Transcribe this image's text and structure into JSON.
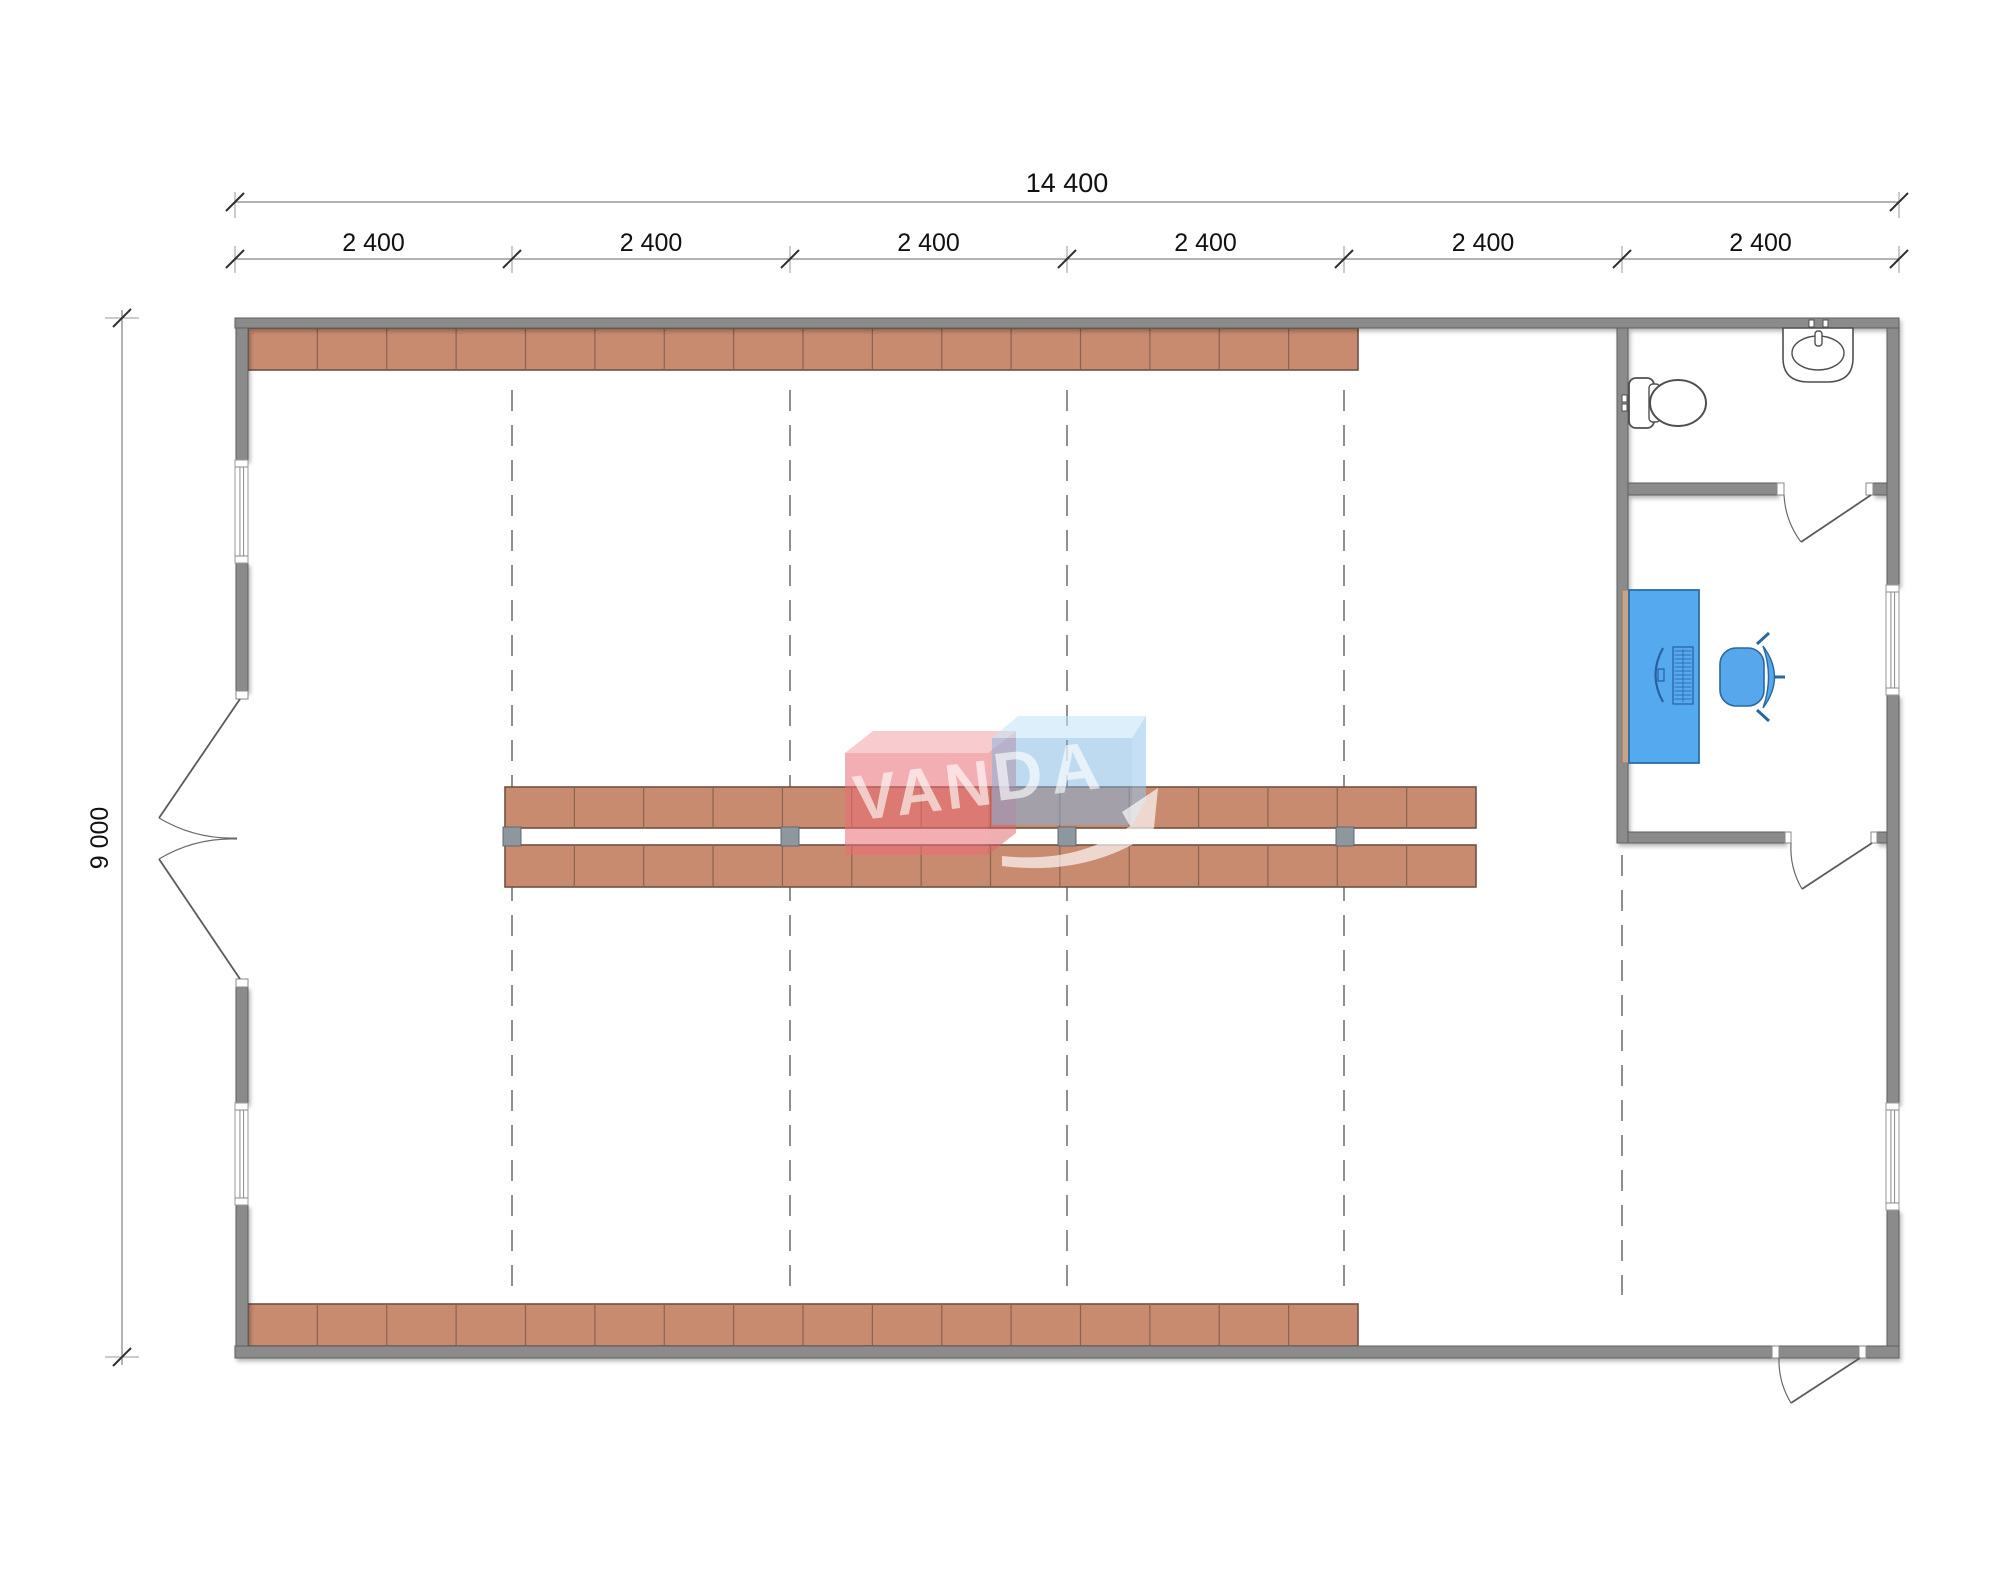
{
  "page": {
    "background": "#ffffff"
  },
  "labels": {
    "total_width": "14 400",
    "bays": [
      "2 400",
      "2 400",
      "2 400",
      "2 400",
      "2 400",
      "2 400"
    ],
    "height": "9 000",
    "watermark_left": "VAN",
    "watermark_right": "DA"
  },
  "colors": {
    "wall": "#8b8b8b",
    "wall_edge": "#5e5e5e",
    "shelf": "#c98b70",
    "shelf_edge": "#6f5243",
    "shelf_div": "#8a6251",
    "post": "#8d979d",
    "post_edge": "#5f6a70",
    "dash": "#8f8f8f",
    "dim": "#9a9a9a",
    "tick": "#2e2e2e",
    "text": "#111111",
    "fixture": "#4f4f4f",
    "desk": "#54a9ef",
    "desk_edge": "#2a6da8",
    "desk_side": "#c7a489",
    "device": "#2b5fa0",
    "chair": "#57a7ec",
    "chair_edge": "#2b689f",
    "wm_red": "rgba(234,108,116,0.55)",
    "wm_red_top": "rgba(243,160,166,0.55)",
    "wm_red_side": "rgba(222,95,104,0.5)",
    "wm_blue": "rgba(126,181,226,0.5)",
    "wm_blue_top": "rgba(196,228,247,0.6)",
    "wm_blue_side": "rgba(150,198,235,0.55)",
    "wm_text": "rgba(255,255,255,0.62)",
    "wm_arrow": "rgba(255,255,255,0.66)"
  },
  "geometry": {
    "canvas": {
      "w": 2000,
      "h": 1574
    },
    "walls": [
      [
        235,
        318,
        1664,
        10
      ],
      [
        235,
        1346,
        1664,
        12
      ],
      [
        236,
        328,
        12,
        132
      ],
      [
        236,
        563,
        12,
        128
      ],
      [
        236,
        987,
        12,
        116
      ],
      [
        236,
        1205,
        12,
        141
      ],
      [
        1887,
        328,
        12,
        257
      ],
      [
        1887,
        695,
        12,
        408
      ],
      [
        1887,
        1210,
        12,
        136
      ],
      [
        1617,
        328,
        11,
        515
      ],
      [
        1628,
        483,
        149,
        12
      ],
      [
        1873,
        483,
        14,
        12
      ],
      [
        1628,
        832,
        157,
        11
      ],
      [
        1877,
        832,
        10,
        11
      ]
    ],
    "windows": [
      [
        235,
        460,
        13,
        103
      ],
      [
        235,
        1103,
        13,
        102
      ],
      [
        1886,
        585,
        13,
        110
      ],
      [
        1886,
        1103,
        13,
        107
      ]
    ],
    "jambs": [
      [
        236,
        691,
        12,
        8
      ],
      [
        236,
        979,
        12,
        8
      ],
      [
        1777,
        483,
        7,
        12
      ],
      [
        1866,
        483,
        7,
        12
      ],
      [
        1785,
        832,
        6,
        11
      ],
      [
        1871,
        832,
        6,
        11
      ],
      [
        1772,
        1346,
        7,
        12
      ],
      [
        1859,
        1346,
        7,
        12
      ]
    ],
    "doors": [
      {
        "name": "bathroom-door",
        "leaf": [
          1871,
          495,
          1801,
          542
        ],
        "arc": "M1784,495 A86,86 0 0 0 1801,542"
      },
      {
        "name": "office-door",
        "leaf": [
          1872,
          843,
          1802,
          889
        ],
        "arc": "M1791,843 A82,82 0 0 0 1802,889"
      },
      {
        "name": "exit-door",
        "leaf": [
          1860,
          1358,
          1791,
          1403
        ],
        "arc": "M1779,1358 A82,82 0 0 0 1791,1403"
      },
      {
        "name": "entry-door-top-leaf",
        "leaf": [
          240,
          699,
          159,
          818
        ],
        "arc": "M159,818 A143,143 0 0 0 237,838"
      },
      {
        "name": "entry-door-bottom-leaf",
        "leaf": [
          240,
          979,
          159,
          859
        ],
        "arc": "M159,859 A143,143 0 0 1 237,839"
      }
    ],
    "shelf_rows": [
      {
        "x": 248,
        "y": 328,
        "w": 1110,
        "h": 42,
        "segments": 16
      },
      {
        "x": 248,
        "y": 1304,
        "w": 1110,
        "h": 42,
        "segments": 16
      },
      {
        "x": 505,
        "y": 787,
        "w": 971,
        "h": 41,
        "segments": 14
      },
      {
        "x": 505,
        "y": 845,
        "w": 971,
        "h": 42,
        "segments": 14
      }
    ],
    "posts": [
      [
        503,
        827,
        18,
        19
      ],
      [
        781,
        827,
        18,
        19
      ],
      [
        1058,
        827,
        18,
        19
      ],
      [
        1336,
        827,
        18,
        19
      ]
    ],
    "grid_lines": [
      {
        "x": 512,
        "y1": 390,
        "y2": 1295
      },
      {
        "x": 790,
        "y1": 390,
        "y2": 1295
      },
      {
        "x": 1067,
        "y1": 390,
        "y2": 1295
      },
      {
        "x": 1344,
        "y1": 390,
        "y2": 1295
      },
      {
        "x": 1622,
        "y1": 855,
        "y2": 1295
      }
    ],
    "dim": {
      "top_line_y": 202,
      "bay_line_y": 259,
      "left_line_x": 122,
      "x_ticks": [
        235,
        512,
        790,
        1067,
        1344,
        1622,
        1899
      ],
      "y_span": [
        318,
        1357
      ],
      "total_label_pos": [
        1067,
        192
      ],
      "bay_label_y": 251,
      "height_label_pos": [
        108,
        838
      ]
    },
    "fixtures": {
      "toilet": {
        "tank": [
          1629,
          378,
          25,
          50
        ],
        "lid": [
          1649,
          384,
          11,
          38
        ],
        "bowl": [
          1678,
          403,
          28,
          23
        ],
        "buttons": [
          [
            1622,
            395,
            5,
            7
          ],
          [
            1622,
            404,
            5,
            7
          ]
        ]
      },
      "sink": {
        "body": [
          1783,
          328,
          70,
          54
        ],
        "basin": [
          1818,
          353,
          26,
          17
        ],
        "faucet": [
          1815,
          331,
          7,
          15
        ],
        "taps": [
          [
            1809,
            320,
            5,
            7
          ],
          [
            1823,
            320,
            5,
            7
          ]
        ]
      },
      "desk": {
        "side": [
          1622,
          590,
          7,
          173
        ],
        "top": [
          1629,
          590,
          70,
          173
        ],
        "monitor_cx": 1657,
        "monitor_cy": 675,
        "keyboard": [
          1673,
          647,
          20,
          57
        ]
      },
      "chair": {
        "seat": [
          1720,
          648,
          44,
          58
        ]
      }
    },
    "watermark": {
      "red_top": [
        [
          845,
          753
        ],
        [
          873,
          731
        ],
        [
          1016,
          731
        ],
        [
          988,
          753
        ]
      ],
      "red_front": [
        845,
        753,
        143,
        102
      ],
      "red_side": [
        [
          988,
          753
        ],
        [
          1016,
          731
        ],
        [
          1016,
          833
        ],
        [
          988,
          855
        ]
      ],
      "blue_top": [
        [
          992,
          738
        ],
        [
          1018,
          716
        ],
        [
          1146,
          716
        ],
        [
          1132,
          738
        ]
      ],
      "blue_front": [
        992,
        738,
        140,
        87
      ],
      "blue_side": [
        [
          1132,
          738
        ],
        [
          1146,
          716
        ],
        [
          1146,
          800
        ],
        [
          1132,
          825
        ]
      ],
      "arrow": "M1002,856 Q1078,864 1130,826 L1122,812 L1158,788 L1154,828 L1144,838 Q1082,876 1002,866 Z",
      "text_left_pos": [
        927,
        812
      ],
      "text_right_pos": [
        1053,
        794
      ],
      "font_size": 64,
      "rotate": -7
    }
  }
}
